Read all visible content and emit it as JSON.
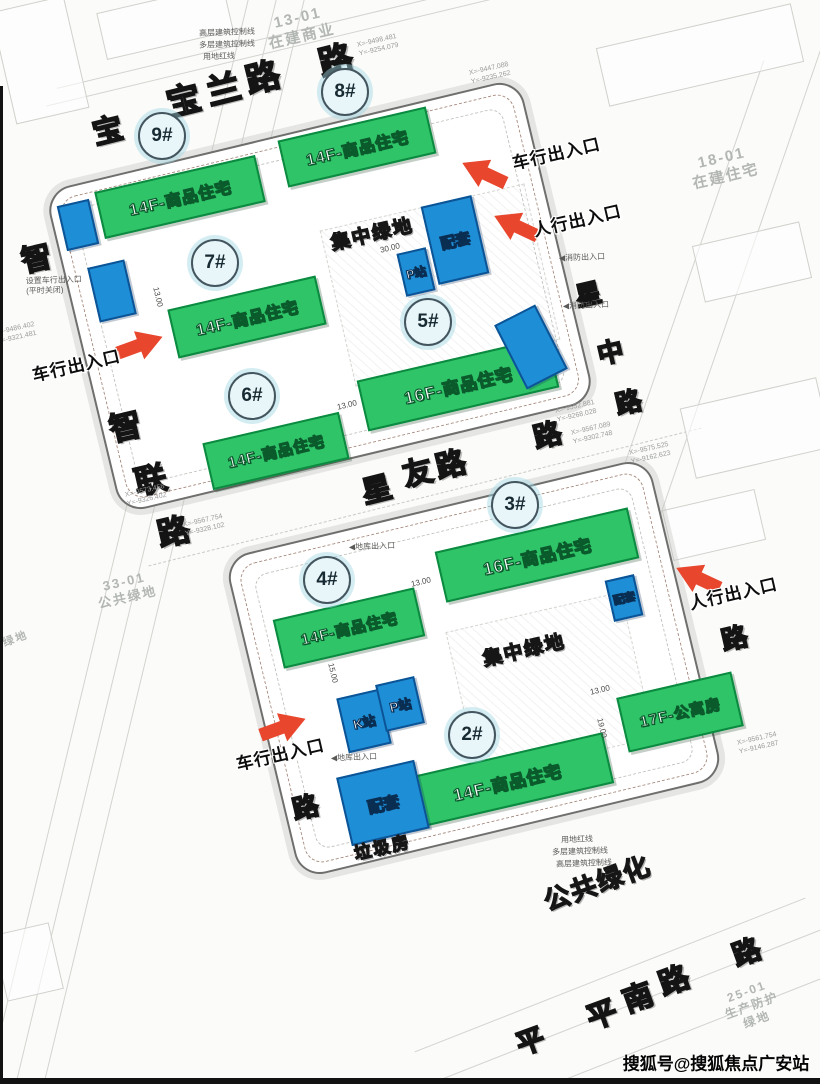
{
  "canvas": {
    "width": 820,
    "height": 1084
  },
  "colors": {
    "building_green": "#2fc468",
    "building_border": "#0b8a40",
    "facility_blue": "#1e8ed6",
    "facility_border": "#0c5496",
    "arrow_red": "#e8462d",
    "parcel_gray": "#b3b7b3"
  },
  "roads": [
    {
      "name": "宝兰路",
      "chars": [
        {
          "c": "宝",
          "x": 107,
          "y": 128,
          "fs": 30,
          "rot": -14
        },
        {
          "c": "宝",
          "x": 183,
          "y": 98,
          "fs": 34,
          "rot": -14
        },
        {
          "c": "兰",
          "x": 223,
          "y": 87,
          "fs": 34,
          "rot": -14
        },
        {
          "c": "路",
          "x": 262,
          "y": 75,
          "fs": 34,
          "rot": -14
        },
        {
          "c": "路",
          "x": 335,
          "y": 58,
          "fs": 34,
          "rot": -14
        }
      ]
    },
    {
      "name": "智联路",
      "chars": [
        {
          "c": "智",
          "x": 36,
          "y": 256,
          "fs": 30,
          "rot": -13
        },
        {
          "c": "智",
          "x": 125,
          "y": 425,
          "fs": 32,
          "rot": -13
        },
        {
          "c": "联",
          "x": 150,
          "y": 478,
          "fs": 32,
          "rot": -13
        },
        {
          "c": "路",
          "x": 173,
          "y": 530,
          "fs": 32,
          "rot": -13
        },
        {
          "c": "路",
          "x": 305,
          "y": 806,
          "fs": 26,
          "rot": -13
        }
      ]
    },
    {
      "name": "星友路",
      "chars": [
        {
          "c": "星",
          "x": 376,
          "y": 487,
          "fs": 30,
          "rot": -14
        },
        {
          "c": "友",
          "x": 417,
          "y": 470,
          "fs": 30,
          "rot": -14
        },
        {
          "c": "路",
          "x": 450,
          "y": 462,
          "fs": 30,
          "rot": -14
        },
        {
          "c": "路",
          "x": 547,
          "y": 434,
          "fs": 28,
          "rot": -14
        }
      ]
    },
    {
      "name": "星中路",
      "chars": [
        {
          "c": "星",
          "x": 588,
          "y": 293,
          "fs": 26,
          "rot": -13
        },
        {
          "c": "中",
          "x": 610,
          "y": 351,
          "fs": 26,
          "rot": -13
        },
        {
          "c": "路",
          "x": 628,
          "y": 401,
          "fs": 26,
          "rot": -13
        },
        {
          "c": "路",
          "x": 734,
          "y": 637,
          "fs": 26,
          "rot": -13
        }
      ]
    },
    {
      "name": "平南路",
      "chars": [
        {
          "c": "平",
          "x": 530,
          "y": 1040,
          "fs": 28,
          "rot": -20
        },
        {
          "c": "平",
          "x": 601,
          "y": 1012,
          "fs": 30,
          "rot": -20
        },
        {
          "c": "南",
          "x": 637,
          "y": 995,
          "fs": 30,
          "rot": -20
        },
        {
          "c": "路",
          "x": 673,
          "y": 978,
          "fs": 30,
          "rot": -20
        },
        {
          "c": "路",
          "x": 746,
          "y": 951,
          "fs": 28,
          "rot": -20
        }
      ]
    }
  ],
  "parcels": [
    {
      "lines": [
        "13-01",
        "在建商业"
      ],
      "x": 300,
      "y": 28,
      "fs": 15,
      "rot": -13
    },
    {
      "lines": [
        "18-01",
        "在建住宅"
      ],
      "x": 724,
      "y": 168,
      "fs": 15,
      "rot": -13
    },
    {
      "lines": [
        "33-01",
        "公共绿地"
      ],
      "x": 126,
      "y": 590,
      "fs": 13,
      "rot": -13
    },
    {
      "lines": [
        "25-01",
        "生产防护绿地"
      ],
      "x": 752,
      "y": 1006,
      "fs": 12,
      "rot": -20
    },
    {
      "lines": [
        "绿地"
      ],
      "x": 16,
      "y": 640,
      "fs": 11,
      "rot": -20
    }
  ],
  "buildings": [
    {
      "id": "9#",
      "label": "14F-商品住宅",
      "circle": {
        "x": 162,
        "y": 136
      },
      "block": {
        "x": 180,
        "y": 197,
        "w": 165,
        "h": 48,
        "rot": -13
      },
      "fs": 16
    },
    {
      "id": "8#",
      "label": "14F-商品住宅",
      "circle": {
        "x": 345,
        "y": 92
      },
      "block": {
        "x": 357,
        "y": 147,
        "w": 152,
        "h": 48,
        "rot": -13
      },
      "fs": 16
    },
    {
      "id": "7#",
      "label": "14F-商品住宅",
      "circle": {
        "x": 215,
        "y": 263
      },
      "block": {
        "x": 247,
        "y": 317,
        "w": 152,
        "h": 50,
        "rot": -13
      },
      "fs": 16
    },
    {
      "id": "6#",
      "label": "14F-商品住宅",
      "circle": {
        "x": 252,
        "y": 396
      },
      "block": {
        "x": 276,
        "y": 451,
        "w": 140,
        "h": 48,
        "rot": -13
      },
      "fs": 15
    },
    {
      "id": "5#",
      "label": "16F-商品住宅",
      "circle": {
        "x": 428,
        "y": 322
      },
      "block": {
        "x": 458,
        "y": 384,
        "w": 196,
        "h": 52,
        "rot": -13
      },
      "fs": 17
    },
    {
      "id": "3#",
      "label": "16F-商品住宅",
      "circle": {
        "x": 515,
        "y": 505
      },
      "block": {
        "x": 537,
        "y": 555,
        "w": 198,
        "h": 52,
        "rot": -13
      },
      "fs": 17
    },
    {
      "id": "4#",
      "label": "14F-商品住宅",
      "circle": {
        "x": 327,
        "y": 580
      },
      "block": {
        "x": 349,
        "y": 628,
        "w": 145,
        "h": 50,
        "rot": -13
      },
      "fs": 15
    },
    {
      "id": "2#",
      "label": "14F-商品住宅",
      "circle": {
        "x": 472,
        "y": 735
      },
      "block": {
        "x": 507,
        "y": 781,
        "w": 208,
        "h": 52,
        "rot": -13
      },
      "fs": 17
    },
    {
      "id": "",
      "label": "17F-公寓房",
      "circle": null,
      "block": {
        "x": 680,
        "y": 712,
        "w": 118,
        "h": 56,
        "rot": -13
      },
      "fs": 15
    }
  ],
  "facilities": [
    {
      "label": "",
      "x": 78,
      "y": 225,
      "w": 33,
      "h": 46,
      "rot": -13,
      "fs": 12
    },
    {
      "label": "",
      "x": 112,
      "y": 291,
      "w": 38,
      "h": 56,
      "rot": -13,
      "fs": 12
    },
    {
      "label": "配套",
      "x": 455,
      "y": 240,
      "w": 52,
      "h": 80,
      "rot": -13,
      "fs": 15
    },
    {
      "label": "P站",
      "x": 416,
      "y": 272,
      "w": 30,
      "h": 44,
      "rot": -13,
      "fs": 12
    },
    {
      "label": "",
      "x": 531,
      "y": 347,
      "w": 46,
      "h": 72,
      "rot": -27,
      "fs": 12
    },
    {
      "label": "配套",
      "x": 624,
      "y": 598,
      "w": 30,
      "h": 42,
      "rot": -13,
      "fs": 11
    },
    {
      "label": "K站",
      "x": 364,
      "y": 721,
      "w": 44,
      "h": 56,
      "rot": -13,
      "fs": 13
    },
    {
      "label": "P站",
      "x": 400,
      "y": 704,
      "w": 40,
      "h": 48,
      "rot": -13,
      "fs": 13
    },
    {
      "label": "配套",
      "x": 383,
      "y": 803,
      "w": 80,
      "h": 70,
      "rot": -13,
      "fs": 16
    }
  ],
  "entrances": [
    {
      "label": "车行出入口",
      "lx": 556,
      "ly": 152,
      "ax": 484,
      "ay": 173,
      "arot": 25
    },
    {
      "label": "人行出入口",
      "lx": 577,
      "ly": 219,
      "ax": 516,
      "ay": 226,
      "arot": 25
    },
    {
      "label": "车行出入口",
      "lx": 76,
      "ly": 364,
      "ax": 140,
      "ay": 345,
      "arot": 160
    },
    {
      "label": "人行出入口",
      "lx": 733,
      "ly": 592,
      "ax": 698,
      "ay": 578,
      "arot": 25
    },
    {
      "label": "车行出入口",
      "lx": 280,
      "ly": 753,
      "ax": 283,
      "ay": 727,
      "arot": 160
    }
  ],
  "site_labels": [
    {
      "t": "集中绿地",
      "x": 372,
      "y": 233,
      "fs": 19,
      "rot": -13
    },
    {
      "t": "集中绿地",
      "x": 524,
      "y": 649,
      "fs": 19,
      "rot": -13
    },
    {
      "t": "公共绿化",
      "x": 597,
      "y": 882,
      "fs": 26,
      "rot": -20
    },
    {
      "t": "垃圾房",
      "x": 382,
      "y": 846,
      "fs": 17,
      "rot": -13
    }
  ],
  "notes": [
    {
      "lines": [
        "高层建筑控制线"
      ],
      "x": 227,
      "y": 33
    },
    {
      "lines": [
        "多层建筑控制线"
      ],
      "x": 227,
      "y": 45
    },
    {
      "lines": [
        "用地红线"
      ],
      "x": 219,
      "y": 57
    },
    {
      "lines": [
        "设置车行出入口",
        "(平时关闭)"
      ],
      "x": 54,
      "y": 286
    },
    {
      "lines": [
        "◀消防出入口"
      ],
      "x": 582,
      "y": 258
    },
    {
      "lines": [
        "◀消防出入口"
      ],
      "x": 586,
      "y": 306
    },
    {
      "lines": [
        "◀地库出入口"
      ],
      "x": 372,
      "y": 547
    },
    {
      "lines": [
        "◀地库出入口"
      ],
      "x": 354,
      "y": 758
    },
    {
      "lines": [
        "用地红线"
      ],
      "x": 577,
      "y": 840
    },
    {
      "lines": [
        "多层建筑控制线"
      ],
      "x": 580,
      "y": 852
    },
    {
      "lines": [
        "高层建筑控制线"
      ],
      "x": 584,
      "y": 864
    }
  ],
  "coords": [
    {
      "lines": [
        "X=-9498.481",
        "Y=-9254.079"
      ],
      "x": 378,
      "y": 46
    },
    {
      "lines": [
        "X=-9447.088",
        "Y=-9235.262"
      ],
      "x": 490,
      "y": 74
    },
    {
      "lines": [
        "X=-9486.402",
        "Y=-9321.481"
      ],
      "x": 16,
      "y": 334
    },
    {
      "lines": [
        "X=-9573.458",
        "Y=-9326.402"
      ],
      "x": 146,
      "y": 496
    },
    {
      "lines": [
        "X=-9567.754",
        "Y=-9328.102"
      ],
      "x": 204,
      "y": 526
    },
    {
      "lines": [
        "X=-9552.881",
        "Y=-9268.028"
      ],
      "x": 576,
      "y": 412
    },
    {
      "lines": [
        "X=-9567.089",
        "Y=-9302.748"
      ],
      "x": 592,
      "y": 434
    },
    {
      "lines": [
        "X=-9575.525",
        "Y=-9162.623"
      ],
      "x": 650,
      "y": 454
    },
    {
      "lines": [
        "X=-9561.754",
        "Y=-9146.287"
      ],
      "x": 758,
      "y": 744
    }
  ],
  "dims": [
    {
      "t": "13.00",
      "x": 158,
      "y": 297,
      "rot": 77
    },
    {
      "t": "30.00",
      "x": 390,
      "y": 248,
      "rot": -13
    },
    {
      "t": "13.00",
      "x": 347,
      "y": 405,
      "rot": -13
    },
    {
      "t": "13.00",
      "x": 421,
      "y": 582,
      "rot": -13
    },
    {
      "t": "15.00",
      "x": 333,
      "y": 673,
      "rot": 77
    },
    {
      "t": "19.00",
      "x": 602,
      "y": 728,
      "rot": 77
    },
    {
      "t": "13.00",
      "x": 600,
      "y": 690,
      "rot": -13
    }
  ],
  "watermark": {
    "text": "搜狐号@搜狐焦点广安站"
  }
}
